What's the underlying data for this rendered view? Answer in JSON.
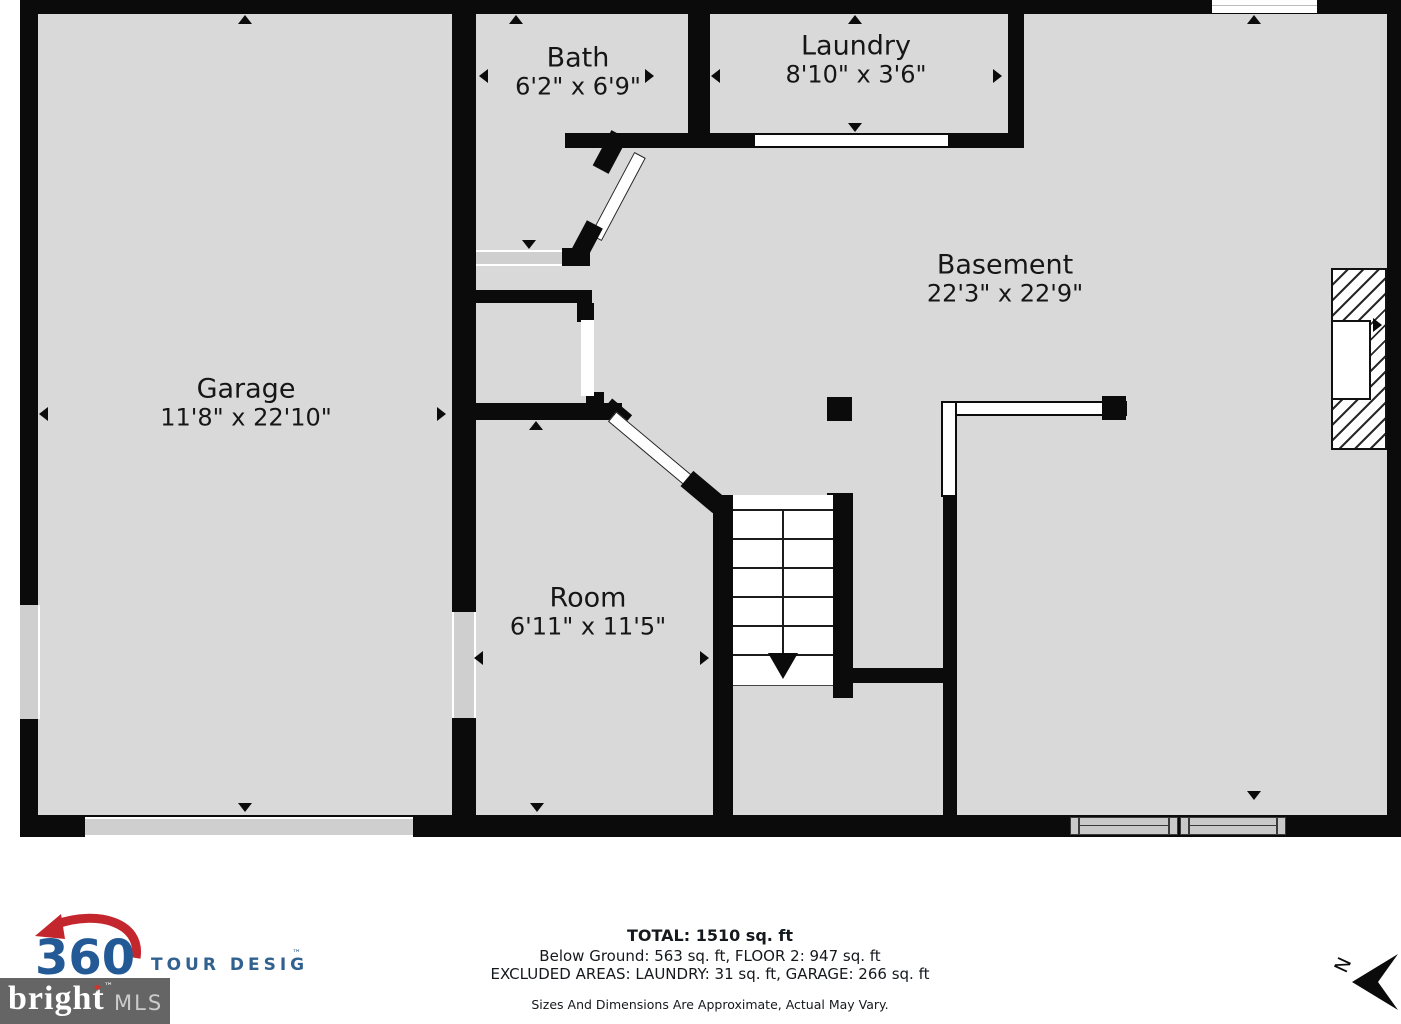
{
  "plan": {
    "rooms": {
      "garage": {
        "name": "Garage",
        "dims": "11'8\" x 22'10\""
      },
      "bath": {
        "name": "Bath",
        "dims": "6'2\" x 6'9\""
      },
      "laundry": {
        "name": "Laundry",
        "dims": "8'10\" x 3'6\""
      },
      "basement": {
        "name": "Basement",
        "dims": "22'3\" x 22'9\""
      },
      "room": {
        "name": "Room",
        "dims": "6'11\" x 11'5\""
      }
    }
  },
  "footer": {
    "total": "TOTAL: 1510 sq. ft",
    "breakdown": "Below Ground: 563 sq. ft, FLOOR 2: 947 sq. ft",
    "excluded": "EXCLUDED AREAS: LAUNDRY: 31 sq. ft, GARAGE: 266 sq. ft",
    "disclaimer": "Sizes And Dimensions Are Approximate, Actual May Vary.",
    "compass": "N"
  },
  "logos": {
    "tour360": {
      "number": "360",
      "words": "TOUR DESIGNS",
      "tm": "™"
    },
    "bright": {
      "word": "bright",
      "tm": "™",
      "suffix": "MLS"
    }
  },
  "colors": {
    "wall": "#0b0b0b",
    "floor": "#d9d9d9",
    "logo_blue": "#235a96",
    "logo_red": "#c4262e",
    "bright_bg": "#656565"
  }
}
